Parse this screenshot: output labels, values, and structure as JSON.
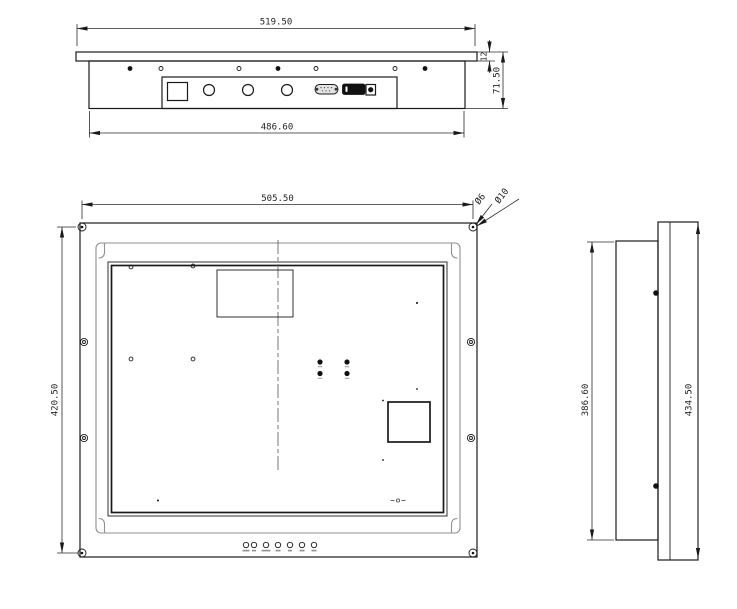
{
  "drawing": {
    "type": "engineering-drawing",
    "subject": "industrial panel-mount monitor, three orthographic views",
    "colors": {
      "line": "#1a1a1a",
      "secondary": "#8f8f8f",
      "background": "#ffffff"
    }
  },
  "views": {
    "top": {
      "name": "top-view",
      "dims": {
        "overall_width": "519.50",
        "body_width": "486.60",
        "front_thickness": "12",
        "total_depth": "71.50"
      }
    },
    "front": {
      "name": "rear-view",
      "dims": {
        "mount_width": "505.50",
        "mount_height": "420.50",
        "hole_dia_small": "Ø6",
        "hole_dia_large": "Ø10"
      }
    },
    "side": {
      "name": "side-view",
      "dims": {
        "body_height": "386.60",
        "panel_height": "434.50"
      }
    }
  }
}
